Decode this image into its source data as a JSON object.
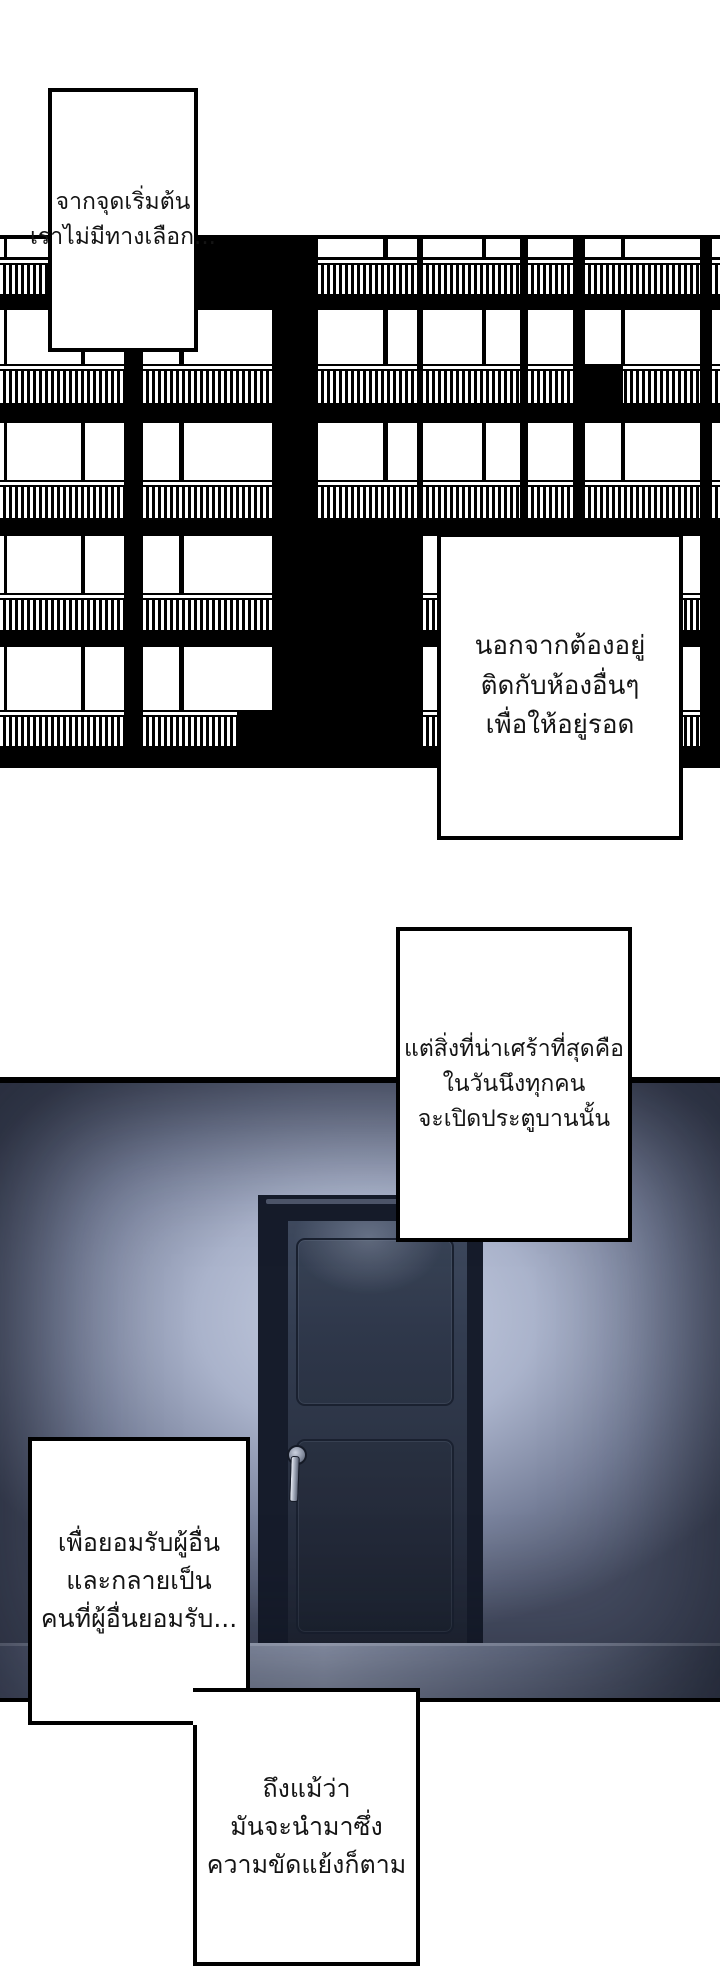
{
  "page": {
    "width": 720,
    "height": 1985,
    "type": "webtoon-comic-page"
  },
  "colors": {
    "ink": "#000000",
    "paper": "#ffffff",
    "wall_light": "#c9d1e4",
    "wall_dark": "#474e63",
    "door_slab": "#2b3344",
    "door_frame": "#161c2b",
    "floor": "#9aa3ba",
    "handle": "#9aa2b2"
  },
  "captions": [
    {
      "x": 48,
      "y": 88,
      "w": 150,
      "h": 264,
      "lines": [
        "จากจุดเริ่มต้น",
        "เราไม่มีทางเลือก..."
      ]
    },
    {
      "x": 437,
      "y": 533,
      "w": 246,
      "h": 307,
      "lines": [
        "นอกจากต้องอยู่",
        "ติดกับห้องอื่นๆ",
        "เพื่อให้อยู่รอด"
      ]
    },
    {
      "x": 396,
      "y": 927,
      "w": 236,
      "h": 315,
      "lines": [
        "แต่สิ่งที่น่าเศร้าที่สุดคือ",
        "ในวันนึงทุกคน",
        "จะเปิดประตูบานนั้น"
      ]
    },
    {
      "x": 28,
      "y": 1437,
      "w": 222,
      "h": 288,
      "lines": [
        "เพื่อยอมรับผู้อื่น",
        "และกลายเป็น",
        "คนที่ผู้อื่นยอมรับ..."
      ]
    },
    {
      "x": 193,
      "y": 1688,
      "w": 227,
      "h": 278,
      "lines": [
        "ถึงแม้ว่า",
        "มันจะนำมาซึ่ง",
        "ความขัดแย้งก็ตาม"
      ]
    }
  ],
  "building": {
    "y": 235,
    "h": 533,
    "floors": [
      {
        "win_y": 239,
        "win_h": 18,
        "sep_y": 260,
        "rail_y": 264,
        "rail_h": 29,
        "cols": [
          0,
          2,
          3,
          4,
          5,
          6
        ]
      },
      {
        "win_y": 310,
        "win_h": 54,
        "sep_y": 366,
        "rail_y": 370,
        "rail_h": 32,
        "cols": [
          0,
          1,
          2,
          3,
          4,
          5,
          6
        ]
      },
      {
        "win_y": 423,
        "win_h": 57,
        "sep_y": 482,
        "rail_y": 486,
        "rail_h": 31,
        "cols": [
          0,
          1,
          2,
          3,
          4,
          5,
          6
        ]
      },
      {
        "win_y": 536,
        "win_h": 57,
        "sep_y": 595,
        "rail_y": 599,
        "rail_h": 30,
        "cols": [
          0,
          1,
          3,
          4,
          5
        ]
      },
      {
        "win_y": 647,
        "win_h": 63,
        "sep_y": 712,
        "rail_y": 716,
        "rail_h": 29,
        "cols": [
          0,
          1,
          3,
          4,
          5
        ]
      }
    ],
    "columns": [
      {
        "lights": [
          [
            0,
            4
          ],
          [
            7,
            81
          ],
          [
            85,
            124
          ]
        ]
      },
      {
        "lights": [
          [
            143,
            179
          ],
          [
            184,
            272
          ]
        ]
      },
      {
        "lights": [
          [
            318,
            383
          ],
          [
            388,
            417
          ]
        ]
      },
      {
        "lights": [
          [
            423,
            482
          ],
          [
            486,
            520
          ]
        ]
      },
      {
        "lights": [
          [
            528,
            573
          ]
        ]
      },
      {
        "lights": [
          [
            585,
            621
          ],
          [
            625,
            700
          ]
        ]
      },
      {
        "lights": [
          [
            712,
            720
          ]
        ]
      }
    ],
    "dark_patches": [
      [
        585,
        366,
        38,
        38
      ],
      [
        237,
        712,
        35,
        34
      ]
    ]
  }
}
